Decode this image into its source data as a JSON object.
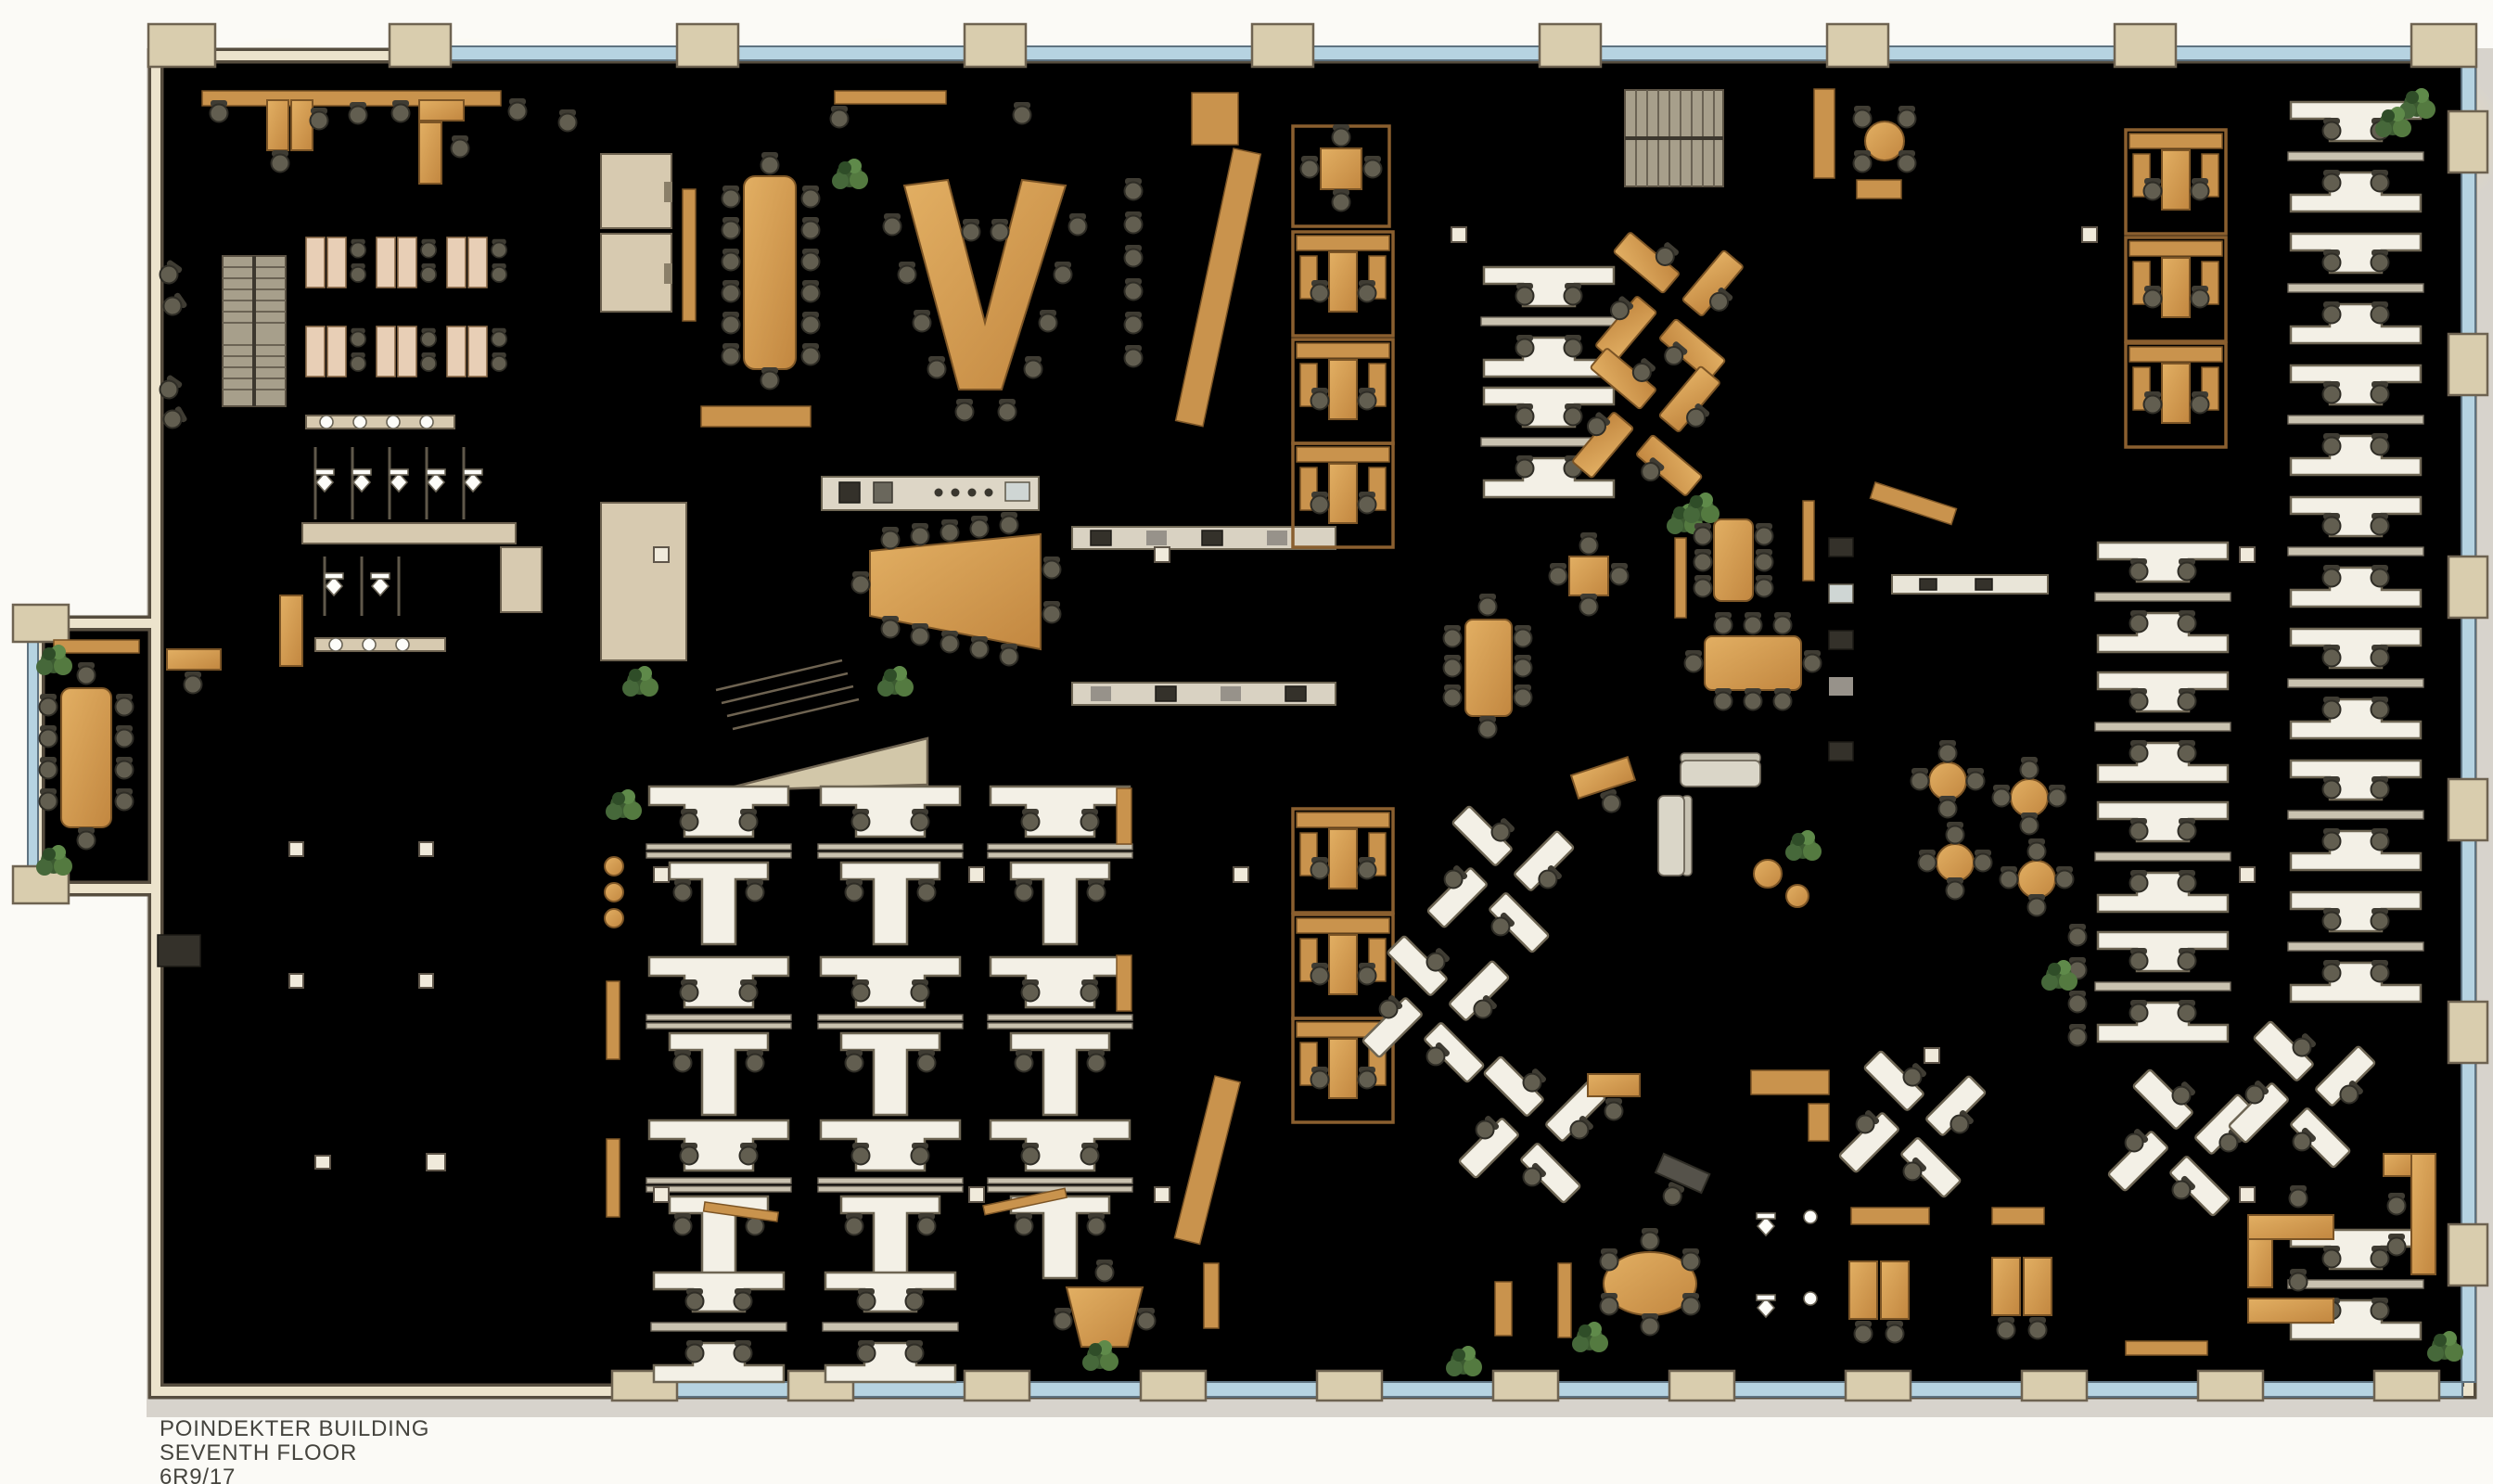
{
  "title_block": {
    "building_name": "POINDEKTER BUILDING",
    "floor_name": "SEVENTH FLOOR",
    "plan_code": "6R9/17"
  },
  "palette": {
    "paper": "#fbfaf6",
    "carpet": "#8f8a77",
    "carpet_alt": "#9a9481",
    "unfinished_floor": "#cbb992",
    "tile_floor": "#ccd1ce",
    "wall_fill": "#ece3cc",
    "wall_line": "#564d3f",
    "wood_furniture": "#d9a359",
    "white_workstation": "#f3f0e6",
    "window_glass": "#b6d3e1",
    "plant_green": "#47683a",
    "warm_light": "#f6e3ae"
  }
}
